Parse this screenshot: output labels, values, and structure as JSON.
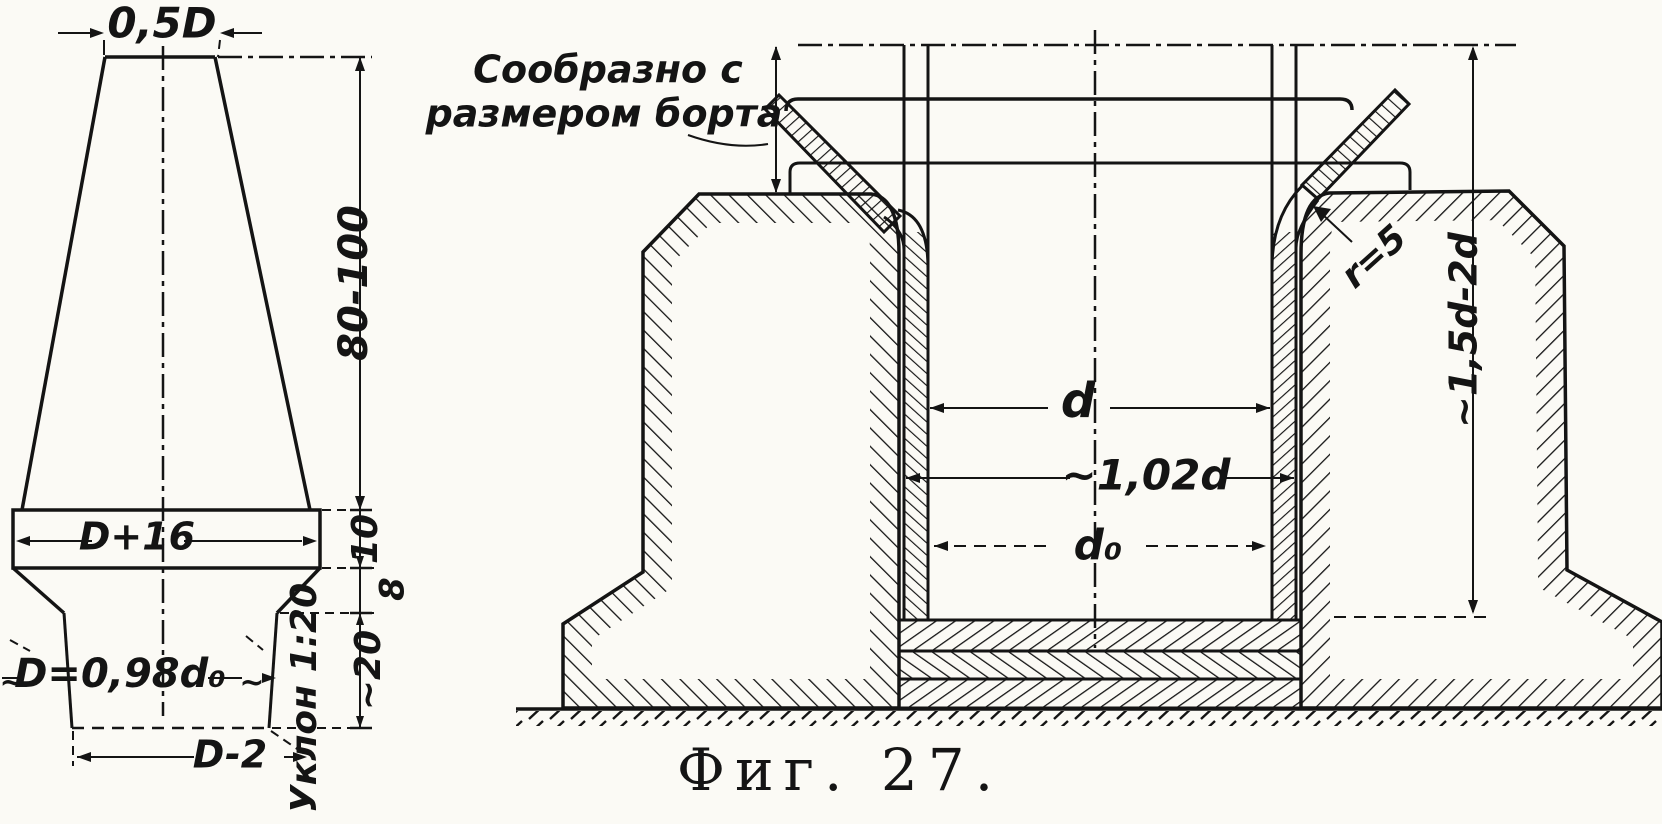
{
  "figure": {
    "caption": "Фиг. 27.",
    "ink_color": "#141414",
    "paper_color": "#fbfaf5"
  },
  "left_view": {
    "dim_top_width": "0,5D",
    "dim_cone_height": "80-100",
    "dim_band_width": "D+16",
    "dim_band_height": "10",
    "dim_chamfer_height": "8",
    "dim_shank_height": "~20",
    "dim_shank_diameter": "D=0,98d₀",
    "approx_tilde": "~",
    "dim_bottom_width": "D-2",
    "taper_label": "Уклон 1:20"
  },
  "right_view": {
    "note_line1": "Сообразно с",
    "note_line2": "размером борта",
    "dim_inner_diameter": "d",
    "dim_bore_diameter": "~1,02d",
    "dim_base_diameter": "d₀",
    "corner_radius": "r=5",
    "dim_depth": "~1,5d-2d"
  }
}
